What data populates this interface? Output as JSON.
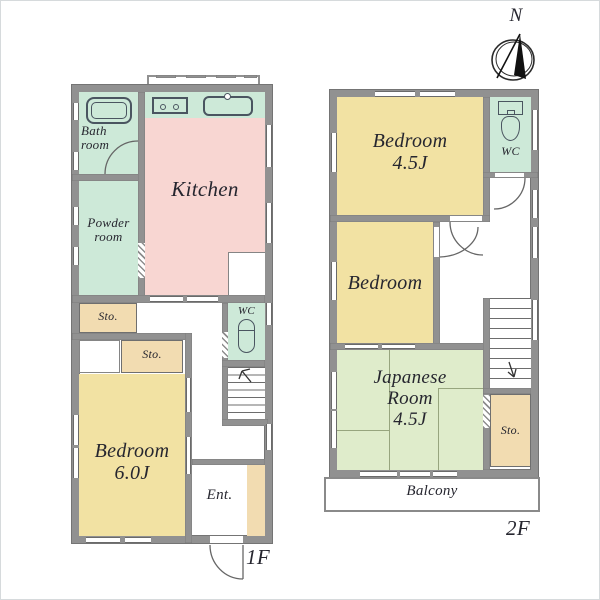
{
  "colors": {
    "wall": "#919191",
    "yellow": "#f2e2a3",
    "pink": "#f8d6d2",
    "mint": "#cde9d8",
    "tatami": "#dfeccb",
    "tan": "#f2dcb1",
    "ink": "#26262f",
    "line": "#6a6a6a"
  },
  "compass": {
    "label": "N"
  },
  "floor1": {
    "label": "1F",
    "bathroom": "Bath\nroom",
    "powder_room": "Powder\nroom",
    "kitchen": "Kitchen",
    "storage_hall": "Sto.",
    "storage_bedroom": "Sto.",
    "wc": "WC",
    "bedroom": "Bedroom\n6.0J",
    "entrance": "Ent."
  },
  "floor2": {
    "label": "2F",
    "bedroom_a": "Bedroom\n4.5J",
    "wc": "WC",
    "bedroom_b": "Bedroom",
    "japanese_room": "Japanese\nRoom\n4.5J",
    "storage": "Sto.",
    "balcony": "Balcony"
  }
}
